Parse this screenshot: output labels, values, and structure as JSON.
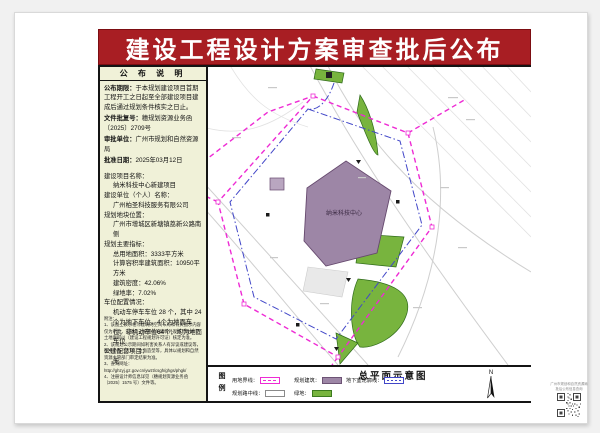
{
  "page_title": "建设工程设计方案审查批后公布",
  "notice_panel": {
    "header": "公 布 说 明",
    "rows": [
      {
        "label": "公布期限：",
        "text": "于本规划建设项目首期工程开工之日起至全部建设项目建成后通过规划条件核实之日止。"
      },
      {
        "label": "文件批复号：",
        "text": "穗规划资源业务函〔2025〕2709号"
      },
      {
        "label": "审批单位：",
        "text": "广州市规划和自然资源局"
      },
      {
        "label": "批准日期：",
        "text": "2025年03月12日"
      }
    ]
  },
  "details": [
    {
      "text": "建设项目名称：",
      "indent": 0
    },
    {
      "text": "纳米科技中心新建项目",
      "indent": 1
    },
    {
      "text": "建设单位（个人）名称：",
      "indent": 0
    },
    {
      "text": "广州柏圣科技服务有限公司",
      "indent": 1
    },
    {
      "text": "规划地块位置：",
      "indent": 0
    },
    {
      "text": "广州市增城区新塘镇荔新公路南侧",
      "indent": 1
    },
    {
      "text": "规划主要指标：",
      "indent": 0
    },
    {
      "text": "总用地面积：3333平方米",
      "indent": 1
    },
    {
      "text": "计算容积率建筑面积：10950平方米",
      "indent": 1
    },
    {
      "text": "建筑密度：42.06%",
      "indent": 1
    },
    {
      "text": "绿地率：7.02%",
      "indent": 1
    },
    {
      "text": "车位配置情况：",
      "indent": 0
    },
    {
      "text": "机动车停车车位 28 个，其中 24 个为地下车位，4个为地面车位；非机动车位64个，均为地面车位",
      "indent": 1
    },
    {
      "text": "公建配套项目：",
      "indent": 0
    },
    {
      "text": "无",
      "indent": 1
    }
  ],
  "notes": [
    "附注：",
    "1、该图上表示相邻建筑的空间布局和有关图示内容仅为示意，实际以上报图纸的建筑外观细节及本市土地面积以〔建设工程规划许可证〕核定为准。",
    "2、该规划公示期间如利害关系人有异议或建议等，图中小品、大样、立面造型等，具体以规划和自然资源主管部门审定结果为准。",
    "3、查询网址：http://ghzyj.gz.gov.cn/ywzt/csgh/ghgs/phgk/",
    "4、注册设计师信息详见（穗规划资源业务函〔2025〕1575 号）文件等。"
  ],
  "site_plan": {
    "title": "总平面示意图",
    "legend_box_label": "图\n例",
    "building_label": "纳米科技中心",
    "compass_label": "N",
    "legend_items": [
      {
        "label": "用地界线："
      },
      {
        "label": "规划建筑："
      },
      {
        "label": "地下室轮廓线："
      },
      {
        "label": "规划路中线："
      },
      {
        "label": "绿地："
      }
    ]
  },
  "qr_panel": {
    "caption": "广州市规划和自然资源局\n批后公布信息查询"
  },
  "colors": {
    "banner_red": "#a81e23",
    "panel_beige": "#f0f1d8",
    "boundary_magenta": "#ee2bd4",
    "basement_blue": "#4247c8",
    "building_purple": "#9d86a6",
    "green_fill": "#78b43e"
  }
}
